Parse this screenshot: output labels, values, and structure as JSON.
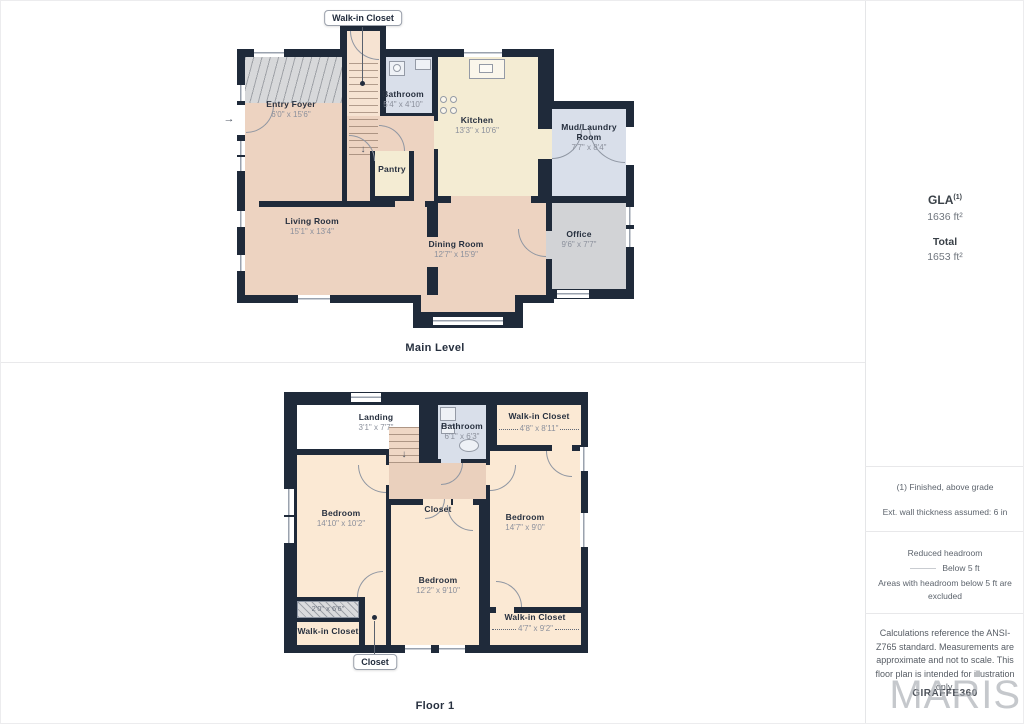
{
  "main_level": {
    "title": "Main Level",
    "callout": "Walk-in Closet",
    "rooms": {
      "entry_foyer": {
        "name": "Entry Foyer",
        "dims": "6'0\" x 15'6\""
      },
      "bathroom": {
        "name": "Bathroom",
        "dims": "5'4\" x 4'10\""
      },
      "kitchen": {
        "name": "Kitchen",
        "dims": "13'3\" x 10'6\""
      },
      "mud_laundry": {
        "name": "Mud/Laundry Room",
        "dims": "7'7\" x 8'4\""
      },
      "pantry": {
        "name": "Pantry"
      },
      "living": {
        "name": "Living Room",
        "dims": "15'1\" x 13'4\""
      },
      "dining": {
        "name": "Dining Room",
        "dims": "12'7\" x 15'9\""
      },
      "office": {
        "name": "Office",
        "dims": "9'6\" x 7'7\""
      }
    }
  },
  "floor_1": {
    "title": "Floor 1",
    "callout": "Closet",
    "rooms": {
      "landing": {
        "name": "Landing",
        "dims": "3'1\" x 7'7\""
      },
      "bathroom": {
        "name": "Bathroom",
        "dims": "6'1\" x 6'3\""
      },
      "wic_top": {
        "name": "Walk-in Closet",
        "dims": "4'8\" x 8'11\""
      },
      "bedroom_left": {
        "name": "Bedroom",
        "dims": "14'10\" x 10'2\""
      },
      "closet_center": {
        "name": "Closet"
      },
      "bedroom_right": {
        "name": "Bedroom",
        "dims": "14'7\" x 9'0\""
      },
      "bedroom_bottom": {
        "name": "Bedroom",
        "dims": "12'2\" x 9'10\""
      },
      "reduced_strip": {
        "dims": "2'0\" x 6'6\""
      },
      "wic_bottom_left": {
        "name": "Walk-in Closet"
      },
      "wic_bottom_right": {
        "name": "Walk-in Closet",
        "dims": "4'7\" x 9'2\""
      }
    }
  },
  "sidebar": {
    "gla_label": "GLA",
    "gla_sup": "(1)",
    "gla_value": "1636 ft²",
    "total_label": "Total",
    "total_value": "1653 ft²",
    "note_finished": "(1) Finished, above grade",
    "note_wall": "Ext. wall thickness assumed: 6 in",
    "legend_title": "Reduced headroom",
    "legend_item": "Below 5 ft",
    "legend_note": "Areas with headroom below 5 ft are excluded",
    "disclaimer": "Calculations reference the ANSI-Z765 standard. Measurements are approximate and not to scale. This floor plan is intended for illustration only.",
    "brand": "GIRAFFE360",
    "watermark": "MARIS"
  },
  "icons": {
    "entry_arrow": "→",
    "stairs_down": "↓"
  },
  "colors": {
    "wall": "#1F2A3A",
    "floor_peach": "#EDD3C1",
    "floor_peach_light": "#FBE9D4",
    "floor_cream": "#F4ECD3",
    "floor_blue": "#D9DFEA",
    "floor_gray": "#D2D3D6",
    "hall_peach": "#EAD0BD",
    "text_dark": "#27303f",
    "text_dim": "#8b909c"
  }
}
